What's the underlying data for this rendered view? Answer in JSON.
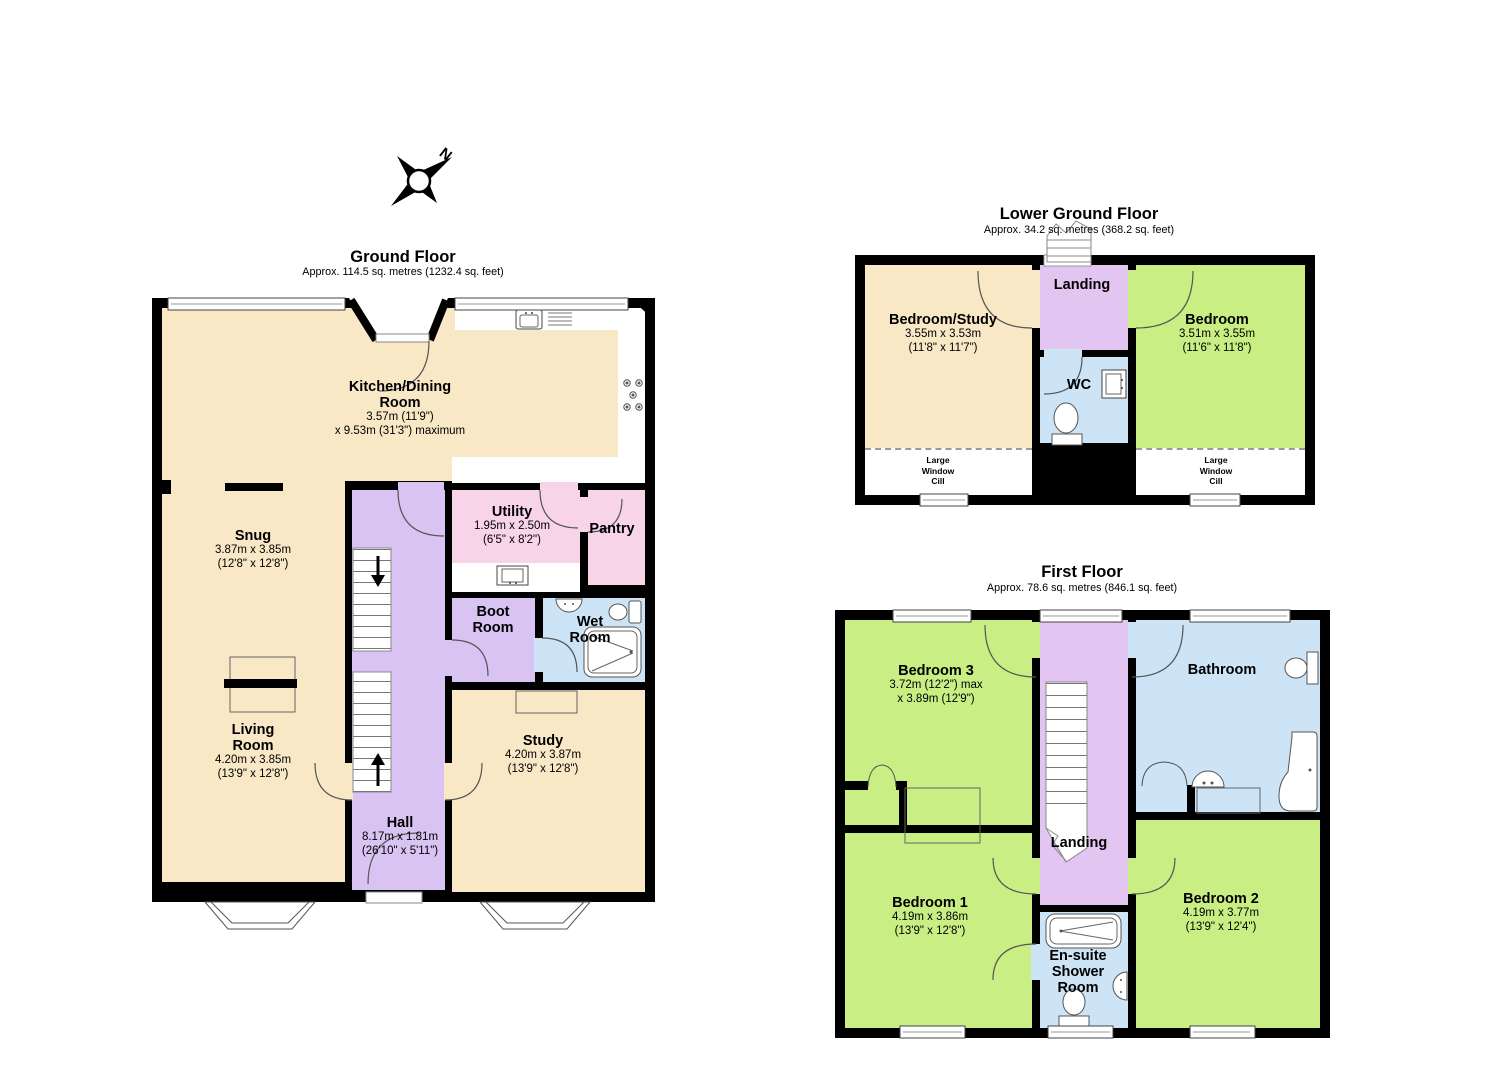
{
  "colors": {
    "cream": "#F8E8C6",
    "green": "#C9EE83",
    "hall_lavender": "#D8C3F2",
    "landing_lavender": "#E3C5F1",
    "pink": "#F8D4E9",
    "blue": "#CCE4F5",
    "wall": "#000000",
    "window_fill": "#FFFFFF"
  },
  "compass": {
    "north_label": "N"
  },
  "floors": {
    "ground": {
      "title": "Ground Floor",
      "subtitle": "Approx. 114.5 sq. metres (1232.4 sq. feet)",
      "rooms": {
        "kitchen": {
          "name": "Kitchen/Dining Room",
          "dim1": "3.57m (11'9\")",
          "dim2": "x 9.53m (31'3\") maximum"
        },
        "snug": {
          "name": "Snug",
          "dim1": "3.87m x 3.85m",
          "dim2": "(12'8\" x 12'8\")"
        },
        "living": {
          "name": "Living Room",
          "dim1": "4.20m x 3.85m",
          "dim2": "(13'9\" x 12'8\")"
        },
        "hall": {
          "name": "Hall",
          "dim1": "8.17m x 1.81m",
          "dim2": "(26'10\" x 5'11\")"
        },
        "study": {
          "name": "Study",
          "dim1": "4.20m x 3.87m",
          "dim2": "(13'9\" x 12'8\")"
        },
        "utility": {
          "name": "Utility",
          "dim1": "1.95m x 2.50m",
          "dim2": "(6'5\" x 8'2\")"
        },
        "pantry": {
          "name": "Pantry"
        },
        "boot": {
          "name": "Boot Room"
        },
        "wet": {
          "name": "Wet Room"
        }
      }
    },
    "lower": {
      "title": "Lower Ground Floor",
      "subtitle": "Approx. 34.2 sq. metres (368.2 sq. feet)",
      "rooms": {
        "bedroom_study": {
          "name": "Bedroom/Study",
          "dim1": "3.55m x 3.53m",
          "dim2": "(11'8\" x 11'7\")"
        },
        "landing": {
          "name": "Landing"
        },
        "wc": {
          "name": "WC"
        },
        "bedroom": {
          "name": "Bedroom",
          "dim1": "3.51m x 3.55m",
          "dim2": "(11'6\" x 11'8\")"
        },
        "cill_left": {
          "name": "Large Window Cill"
        },
        "cill_right": {
          "name": "Large Window Cill"
        }
      }
    },
    "first": {
      "title": "First Floor",
      "subtitle": "Approx. 78.6 sq. metres (846.1 sq. feet)",
      "rooms": {
        "bedroom3": {
          "name": "Bedroom 3",
          "dim1": "3.72m (12'2\") max",
          "dim2": "x 3.89m (12'9\")"
        },
        "bathroom": {
          "name": "Bathroom"
        },
        "landing": {
          "name": "Landing"
        },
        "bedroom1": {
          "name": "Bedroom 1",
          "dim1": "4.19m x 3.86m",
          "dim2": "(13'9\" x 12'8\")"
        },
        "ensuite": {
          "name": "En-suite Shower Room"
        },
        "bedroom2": {
          "name": "Bedroom 2",
          "dim1": "4.19m x 3.77m",
          "dim2": "(13'9\" x 12'4\")"
        }
      }
    }
  }
}
